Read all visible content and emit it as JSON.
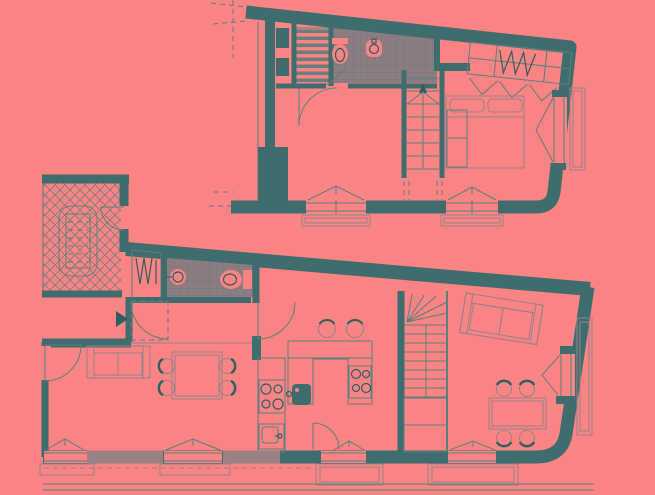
{
  "canvas": {
    "width": 655,
    "height": 495
  },
  "palette": {
    "bg": "#FA8484",
    "wall": "#3F6C6C",
    "wall_dark": "#2F5F5F",
    "masonry": "#9B8084",
    "tile_fill": "#8D7C80",
    "line": "#5E7E7E",
    "furniture": "#95828A",
    "shelf": "#6C7D7D"
  },
  "diagram": {
    "type": "architectural-floor-plan",
    "text_labels": [],
    "floors": [
      {
        "id": "upper-floor-plan",
        "features": [
          "sloped-top-wall",
          "shelved-closet",
          "tiled-bathroom",
          "toilet",
          "washbasin",
          "straight-staircase",
          "wardrobe-with-hangers",
          "bifold-doors",
          "double-bed",
          "two-bottom-windows-with-sills",
          "side-window",
          "door-swings",
          "dashed-projection-lines"
        ]
      },
      {
        "id": "lower-floor-plan",
        "features": [
          "communal-stairwell-crosshatched",
          "stair-flight",
          "entrance-arrow",
          "entry-mat",
          "coat-closet-hangers",
          "tiled-bathroom",
          "round-washbasin",
          "toilet",
          "kitchen-counter",
          "four-burner-cooktop",
          "kitchen-sink",
          "kitchen-island",
          "island-cooktop",
          "island-dark-sink",
          "two-bar-stools",
          "winder-staircase",
          "sofa",
          "dining-table-four-chairs",
          "second-sofa",
          "second-dining-table-four-chairs",
          "four-bottom-windows-with-sills",
          "side-window",
          "door-swings",
          "sidewalk-lines"
        ]
      }
    ]
  }
}
